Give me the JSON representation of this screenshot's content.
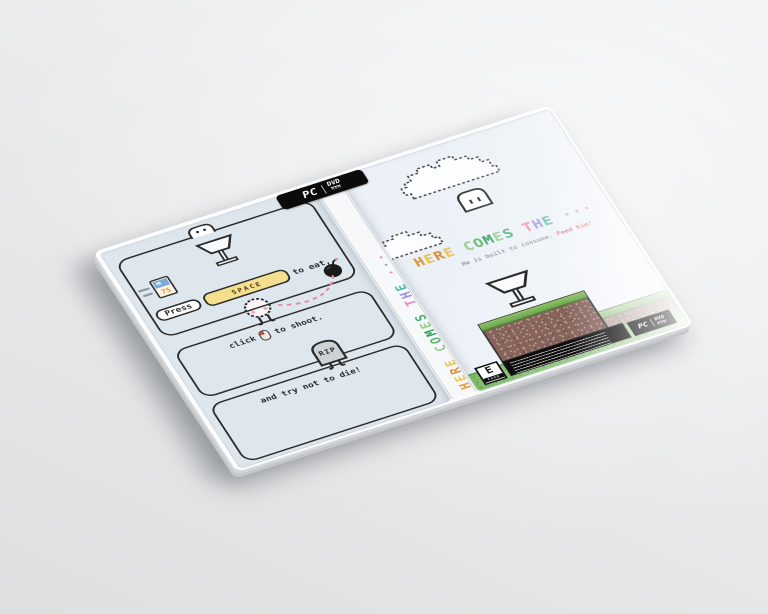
{
  "colors": {
    "back_bg": "#dfe7ee",
    "front_bg": "#ebf1f7",
    "ink": "#2b2b2b",
    "space_key_yellow": "#f4df8e",
    "grass_green": "#7fbb5f",
    "dirt_brown": "#86645c",
    "bottom_strip_green": "#72b65c",
    "trajectory_pink": "#e8899b",
    "subtitle_accent_red": "#e05555"
  },
  "title": {
    "letters": [
      {
        "ch": "H",
        "c": "#e09a3a"
      },
      {
        "ch": "E",
        "c": "#ecc44d"
      },
      {
        "ch": "R",
        "c": "#df8f3f"
      },
      {
        "ch": "E",
        "c": "#ecc44d"
      },
      {
        "ch": " "
      },
      {
        "ch": "C",
        "c": "#8fcf8a"
      },
      {
        "ch": "O",
        "c": "#5cb96e"
      },
      {
        "ch": "M",
        "c": "#2f9e59"
      },
      {
        "ch": "E",
        "c": "#8fcf8a"
      },
      {
        "ch": "S",
        "c": "#45b07a"
      },
      {
        "ch": " "
      },
      {
        "ch": "T",
        "c": "#ee85b5"
      },
      {
        "ch": "H",
        "c": "#9f8fdf"
      },
      {
        "ch": "E",
        "c": "#53bcab"
      },
      {
        "ch": " "
      },
      {
        "ch": "·",
        "c": "#ee85b5"
      },
      {
        "ch": "·",
        "c": "#9f8fdf"
      },
      {
        "ch": "·",
        "c": "#ee85b5"
      }
    ]
  },
  "front": {
    "subtitle": "He is built to consume.",
    "subtitle_accent": "Feed him!",
    "esrb_rating": "E",
    "esrb_org": "ESRB"
  },
  "pcdvd": {
    "pc": "PC",
    "dvd": "DVD",
    "rom": "ROM"
  },
  "back": {
    "press": "Press",
    "key": "SPACE",
    "eat_suffix": "to eat,",
    "shoot_prefix": "click",
    "shoot_suffix": "to shoot.",
    "die_caption": "and try not to die!",
    "grave": "RIP",
    "snack_number": "75"
  }
}
